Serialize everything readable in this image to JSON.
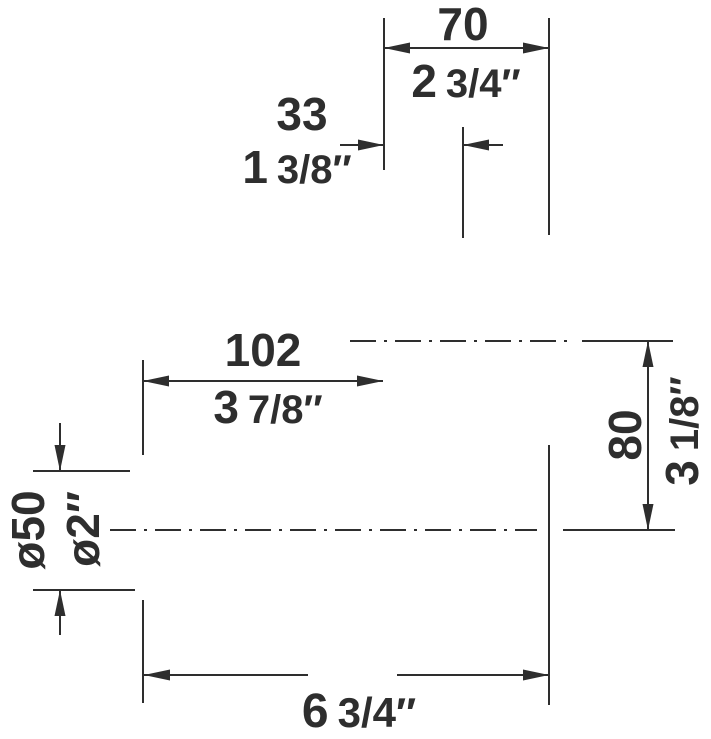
{
  "drawing": {
    "colors": {
      "ink": "#2e2e2e",
      "background": "#ffffff"
    },
    "dimensions": {
      "top_width": {
        "mm": "70",
        "inch_main": "2",
        "inch_frac": "3/4″"
      },
      "top_offset": {
        "mm": "33",
        "inch_main": "1",
        "inch_frac": "3/8″"
      },
      "projection": {
        "mm": "102",
        "inch_main": "3",
        "inch_frac": "7/8″"
      },
      "drop_height": {
        "mm": "80",
        "inch_main": "3",
        "inch_frac": "1/8″"
      },
      "pipe_diameter": {
        "mm": "ø50",
        "inch": "ø2″"
      },
      "bottom_width": {
        "inch_main": "6",
        "inch_frac": "3/4″"
      }
    }
  }
}
